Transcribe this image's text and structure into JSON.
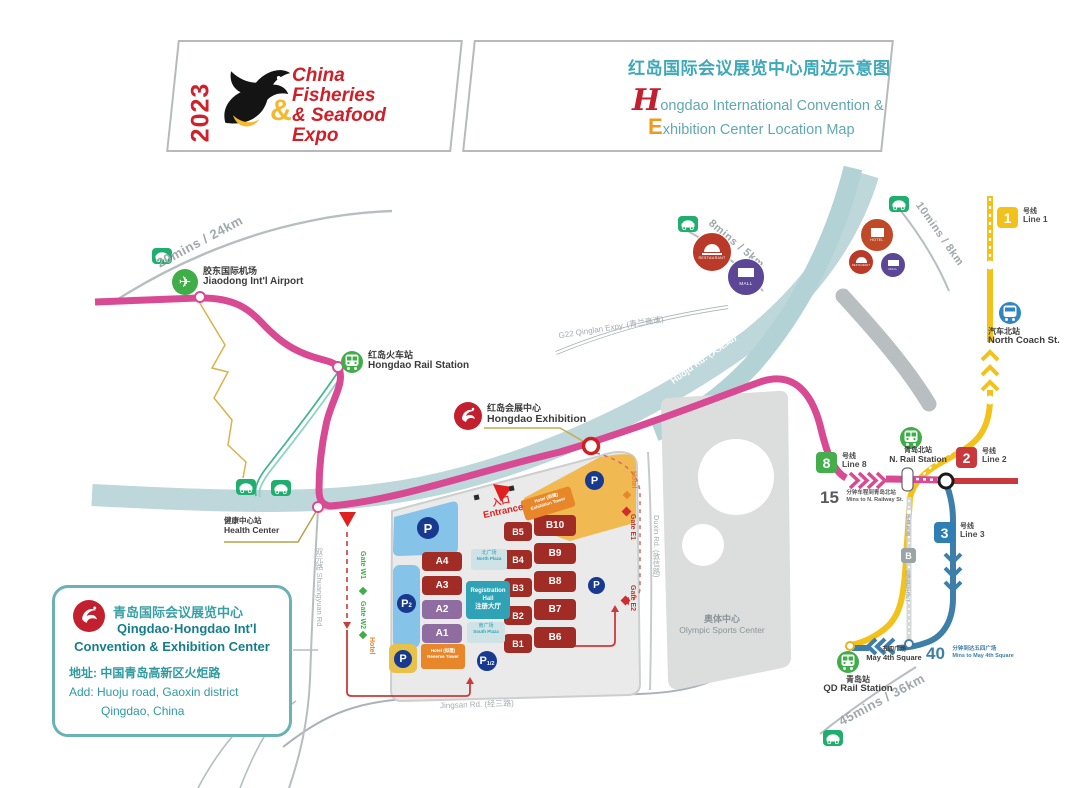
{
  "header": {
    "year": "2023",
    "brand": [
      "China",
      "Fisheries",
      "& Seafood",
      "Expo"
    ],
    "title_zh": "红岛国际会议展览中心周边示意图",
    "title_en1_initial": "H",
    "title_en1_rest": "ongdao International Convention &",
    "title_en2_initial": "E",
    "title_en2_rest": "xhibition Center Location Map"
  },
  "landmarks": {
    "airport": {
      "zh": "胶东国际机场",
      "en": "Jiaodong Int'l Airport"
    },
    "hongdao_rail": {
      "zh": "红岛火车站",
      "en": "Hongdao Rail Station"
    },
    "hongdao_exhibition": {
      "zh": "红岛会展中心",
      "en": "Hongdao Exhibition"
    },
    "health_center": {
      "zh": "健康中心站",
      "en": "Health Center"
    },
    "olympic": {
      "zh": "奥体中心",
      "en": "Olympic Sports Center"
    }
  },
  "roads": {
    "g22": "G22 Qinglan Expy. (青兰高速)",
    "huoju": "Huoju Rd. (火炬路)",
    "s309": "S309 Aodong Rd. (岙东路)",
    "jingsan": "Jingsan Rd. (经三路)",
    "shuangyuan": "双元路 Shuangyuan Rd",
    "duxin": "Duxin Rd. (敦信路)"
  },
  "times": {
    "airport": "20mins / 24km",
    "poi_west": "8mins / 5km",
    "poi_east": "10mins / 8km",
    "qd": "45mins / 36km"
  },
  "transit": {
    "line1": {
      "num": "1",
      "zh": "号线",
      "en": "Line 1"
    },
    "line2": {
      "num": "2",
      "zh": "号线",
      "en": "Line 2"
    },
    "line3": {
      "num": "3",
      "zh": "号线",
      "en": "Line 3"
    },
    "line8": {
      "num": "8",
      "zh": "号线",
      "en": "Line 8"
    },
    "north_coach": {
      "zh": "汽车北站",
      "en": "North Coach St."
    },
    "n_rail": {
      "zh": "青岛北站",
      "en": "N. Rail Station"
    },
    "qd_rail": {
      "zh": "青岛站",
      "en": "QD Rail Station"
    },
    "may4": {
      "zh": "五四广场",
      "en": "May 4th Square"
    },
    "mins15": {
      "num": "15",
      "zh": "分钟车程到青岛北站",
      "en": "Mins to N. Railway St."
    },
    "mins40": {
      "num": "40",
      "zh": "分钟到达五四广场",
      "en": "Mins to May 4th Square"
    },
    "bus_badge": "B",
    "bus_label_top": "环湾大道",
    "bus_label_bottom": "(隧道巴士站)"
  },
  "poi": {
    "restaurant": "RESTAURANT",
    "mall": "MALL",
    "hotel": "HOTEL"
  },
  "campus": {
    "a": [
      "A4",
      "A3",
      "A2",
      "A1"
    ],
    "b_left": [
      "B5",
      "B4",
      "B3",
      "B2",
      "B1"
    ],
    "b_right": [
      "B10",
      "B9",
      "B8",
      "B7",
      "B6"
    ],
    "registration": {
      "en1": "Registration",
      "en2": "Hall",
      "zh": "注册大厅"
    },
    "north_plaza": {
      "zh": "北广场",
      "en": "North Plaza"
    },
    "south_plaza": {
      "zh": "南广场",
      "en": "South Plaza"
    },
    "hotel_top": {
      "l1": "Hotel (拟建)",
      "l2": "Exhibition Tower"
    },
    "hotel_bottom": {
      "l1": "Hotel (拟建)",
      "l2": "Reserve Tower"
    },
    "entrance": {
      "zh": "入口",
      "en": "Entrance"
    },
    "gates": {
      "w1": "Gate W1",
      "w2": "Gate W2",
      "e1": "Gate E1",
      "e2": "Gate E2",
      "hotel_w": "Hotel",
      "hotel_e": "Hotel"
    },
    "parking": {
      "p": "P",
      "p2_sub": "2",
      "p12_sub": "1/2"
    }
  },
  "info_box": {
    "title_zh": "青岛国际会议展览中心",
    "title_en1": "Qingdao·Hongdao Int'l",
    "title_en2": "Convention & Exhibition Center",
    "addr_zh": "地址: 中国青岛高新区火炬路",
    "addr_en1": "Add: Huoju road, Gaoxin district",
    "addr_en2": "Qingdao, China"
  },
  "colors": {
    "line1_yellow": "#f2c21a",
    "line2_red": "#c8383c",
    "line3_blue": "#3d7fa8",
    "line8_pink": "#d84a93",
    "transit_green": "#45ae4c",
    "brand_red": "#d0212a",
    "title_teal": "#3fa9b8",
    "hall_red": "#a12c25",
    "hall_purple": "#8f6da1",
    "registration_teal": "#2fa3b5",
    "parking_navy": "#17398f",
    "amber": "#f0b951",
    "expressway_teal": "#bdd7da"
  }
}
